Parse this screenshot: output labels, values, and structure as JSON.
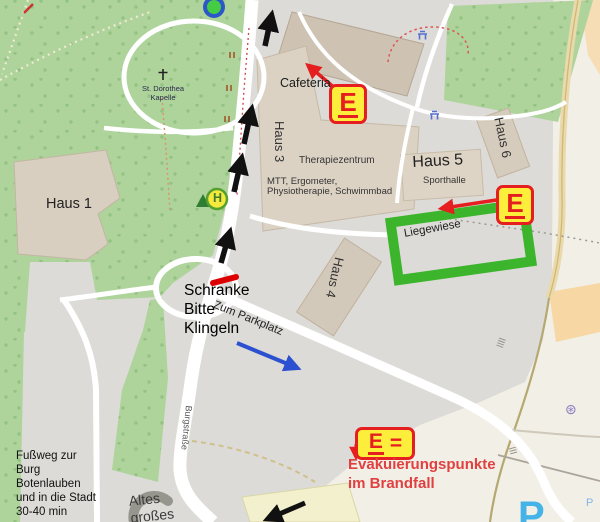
{
  "colors": {
    "forest_green": "#aed49c",
    "liegewiese_green": "#3cb52d",
    "marker_yellow": "#fcee3a",
    "marker_red": "#e51f1f",
    "evac_text_red": "#e04040",
    "arrow_black": "#111111",
    "arrow_blue": "#2b50d0",
    "barrier_red": "#dd0000",
    "parking_blue": "#44b4e8"
  },
  "map": {
    "buildings": {
      "haus1": "Haus 1",
      "haus3": "Haus 3",
      "haus4": "Haus 4",
      "haus5": "Haus 5",
      "haus6": "Haus 6",
      "sporthalle": "Sporthalle",
      "cafeteria": "Cafeteria",
      "therapiezentrum": "Therapiezentrum",
      "therapie_detail_line1": "MTT, Ergometer,",
      "therapie_detail_line2": "Physiotherapie, Schwimmbad",
      "liegewiese": "Liegewiese",
      "altes_line1": "Altes",
      "altes_line2": "großes"
    },
    "labels": {
      "kapelle_line1": "St. Dorothea",
      "kapelle_line2": "Kapelle",
      "strasse": "Burgstraße",
      "bus_stop_letter": "H",
      "parking_letter": "P",
      "parking_small": "P",
      "artwork_glyph": "⊛"
    }
  },
  "annotations": {
    "marker_letter": "E",
    "legend_equals": "=",
    "legend_line1": "Evakuierungspunkte",
    "legend_line2": "im Brandfall",
    "barrier_lines": [
      "Schranke",
      "Bitte",
      "Klingeln"
    ],
    "parkplatz": "Zum Parkplatz",
    "footpath_lines": [
      "Fußweg zur",
      "Burg",
      "Botenlauben",
      "und in die Stadt",
      "30-40 min"
    ]
  }
}
